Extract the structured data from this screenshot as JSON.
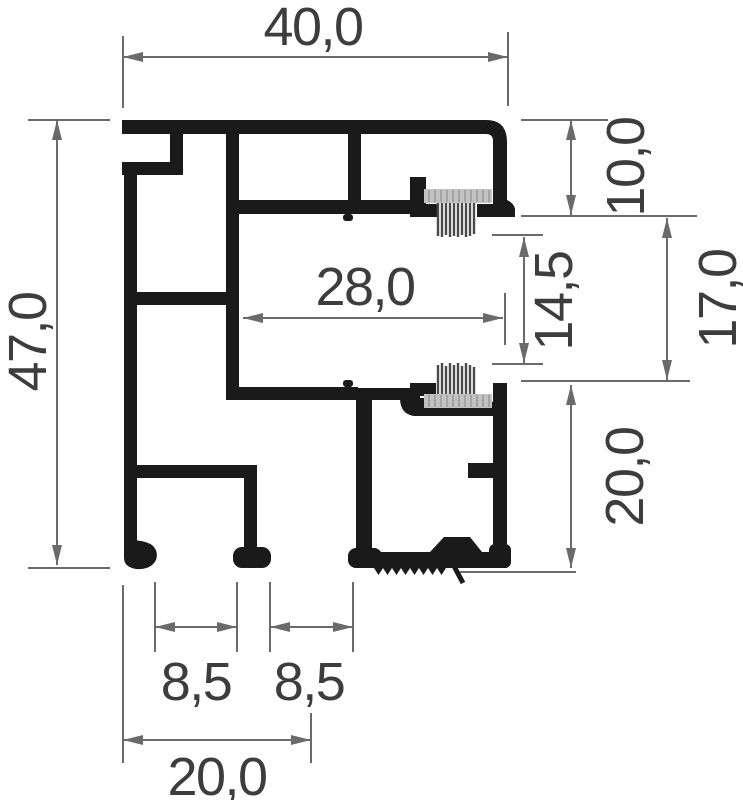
{
  "drawing": {
    "title": "Aluminium profile cross-section with dimensions",
    "labels": {
      "top_width": "40,0",
      "overall_height": "47,0",
      "top_channel_depth": "10,0",
      "opening_height": "17,0",
      "brush_gap": "14,5",
      "inner_width": "28,0",
      "lower_channel_height": "20,0",
      "left_groove_width": "8,5",
      "right_groove_width": "8,5",
      "bottom_width": "20,0"
    },
    "colors": {
      "profile_ink": "#1a1a1a",
      "dimension_line": "#6a6a6a",
      "label_text": "#3d3d3d",
      "brush_backing": "#c2c2c2",
      "brush_hatch": "#8f8f8f",
      "brush_bristles": "#4a4a4a",
      "background": "#ffffff"
    }
  }
}
